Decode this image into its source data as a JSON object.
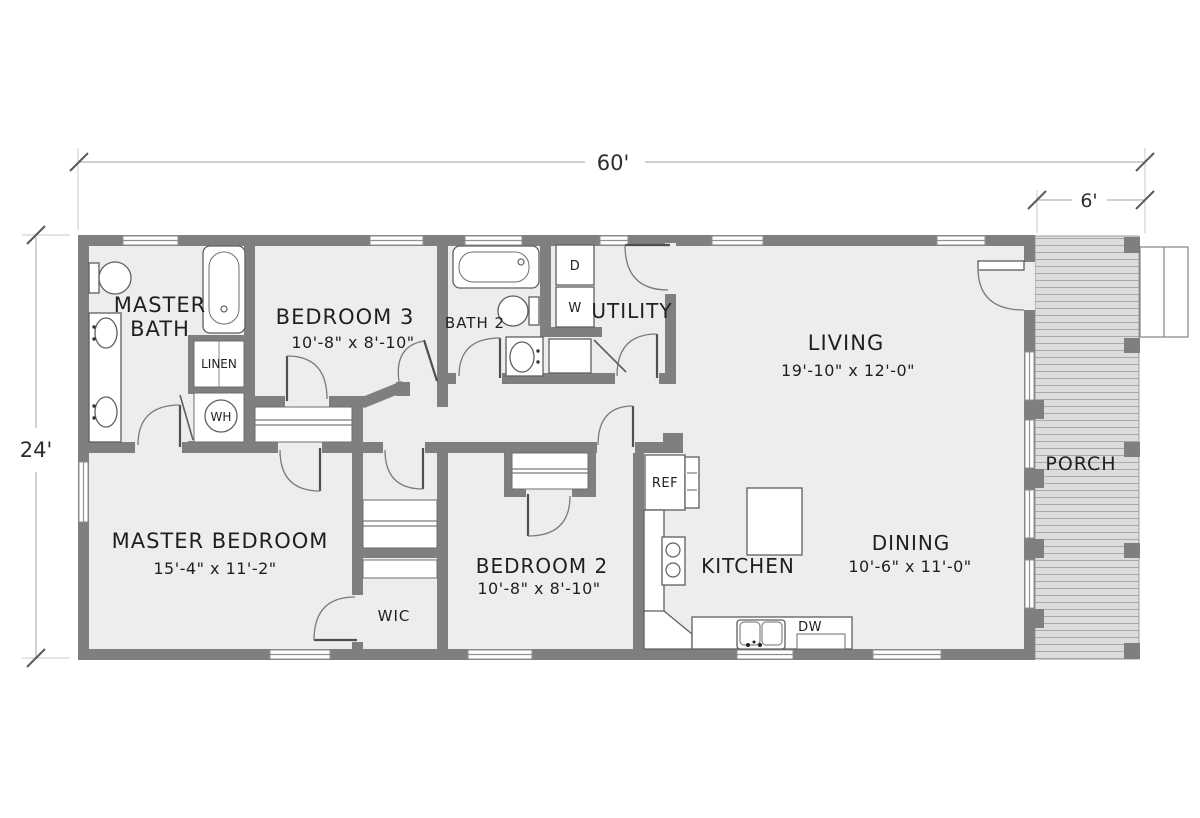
{
  "dimensions": {
    "overall_width": "60'",
    "porch_width": "6'",
    "overall_depth": "24'"
  },
  "rooms": {
    "master_bath": {
      "line1": "MASTER",
      "line2": "BATH"
    },
    "bedroom3": {
      "name": "BEDROOM 3",
      "size": "10'-8\" x 8'-10\""
    },
    "bath2": {
      "name": "BATH 2"
    },
    "utility": {
      "name": "UTILITY"
    },
    "living": {
      "name": "LIVING",
      "size": "19'-10\" x 12'-0\""
    },
    "porch": {
      "name": "PORCH"
    },
    "master_bedroom": {
      "name": "MASTER BEDROOM",
      "size": "15'-4\" x 11'-2\""
    },
    "wic": {
      "name": "WIC"
    },
    "bedroom2": {
      "name": "BEDROOM 2",
      "size": "10'-8\" x 8'-10\""
    },
    "kitchen": {
      "name": "KITCHEN"
    },
    "dining": {
      "name": "DINING",
      "size": "10'-6\" x 11'-0\""
    }
  },
  "fixtures": {
    "linen": "LINEN",
    "water_heater": "WH",
    "dryer": "D",
    "washer": "W",
    "refrigerator": "REF",
    "dishwasher": "DW"
  },
  "colors": {
    "wall": "#7f7f7f",
    "floor": "#ededed",
    "porch_board": "#dcdcdc",
    "porch_line": "#a9a9a9",
    "text": "#1f1f1f"
  }
}
